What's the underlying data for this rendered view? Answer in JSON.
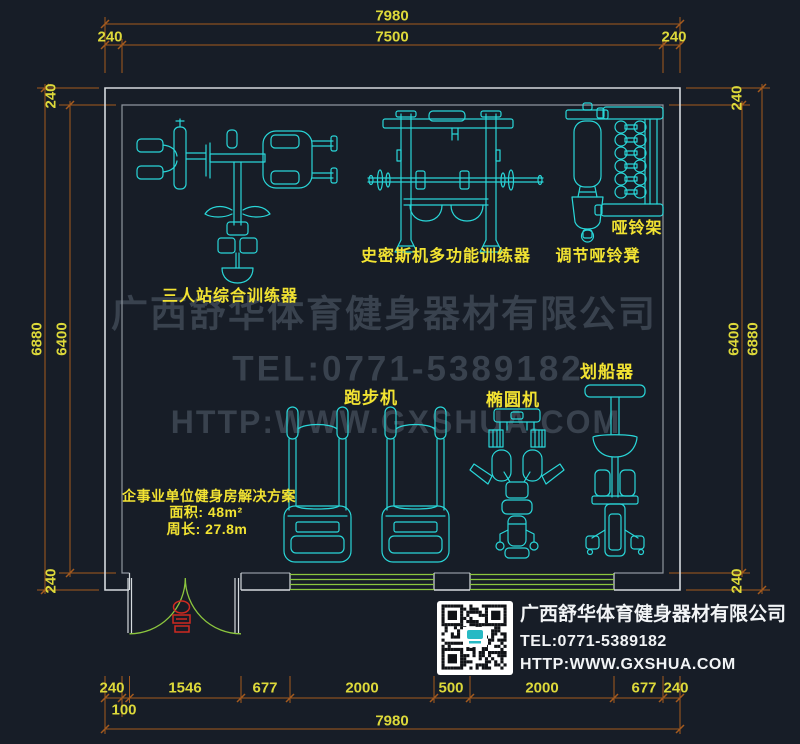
{
  "dims": {
    "top": {
      "total": "7980",
      "inner": "7500",
      "left_wall": "240",
      "right_wall": "240"
    },
    "left": {
      "outer": "6880",
      "inner": "6400",
      "top_wall": "240",
      "bottom_wall": "240"
    },
    "right": {
      "outer": "6880",
      "inner": "6400",
      "top_wall": "240",
      "bottom_wall": "240"
    },
    "bottom": {
      "segments": [
        "240",
        "1546",
        "677",
        "2000",
        "500",
        "2000",
        "677",
        "240"
      ],
      "sub_offset": "100",
      "total": "7980"
    }
  },
  "labels": {
    "multi_station": "三人站综合训练器",
    "smith_machine": "史密斯机多功能训练器",
    "adjustable_bench": "调节哑铃凳",
    "dumbbell_rack": "哑铃架",
    "treadmill": "跑步机",
    "elliptical": "椭圆机",
    "rower": "划船器"
  },
  "solution": {
    "title": "企事业单位健身房解决方案",
    "area": "面积: 48m²",
    "perimeter": "周长: 27.8m"
  },
  "watermark": {
    "company": "广西舒华体育健身器材有限公司",
    "tel": "TEL:0771-5389182",
    "website": "HTTP:WWW.GXSHUA.COM"
  },
  "footer": {
    "company": "广西舒华体育健身器材有限公司",
    "tel": "TEL:0771-5389182",
    "website": "HTTP:WWW.GXSHUA.COM"
  },
  "colors": {
    "background": "#171d27",
    "dimension_line": "#a45a1e",
    "dimension_text": "#ddd93a",
    "wall_outer": "#d5dade",
    "wall_inner": "#8f969e",
    "equipment": "#29d6d8",
    "label_text": "#f2e332",
    "watermark": "#39424e",
    "window_door": "#8cc63e",
    "door_tag": "#cf2a21",
    "footer_text": "#f2f4f6"
  }
}
